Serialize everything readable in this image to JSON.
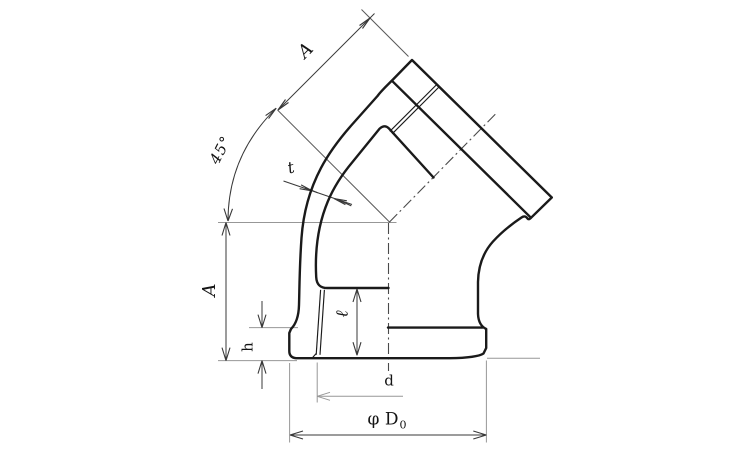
{
  "drawing": {
    "kind": "45-degree banded elbow, half-section dimension drawing",
    "labels": {
      "length_top": "A",
      "angle": "45°",
      "wall_thickness": "t",
      "length_left": "A",
      "band_height": "h",
      "thread_length": "ℓ",
      "inner_diameter": "d",
      "outer_diameter": "φ D",
      "outer_diameter_subscript": "0"
    },
    "colors": {
      "outline": "#1a1a1a",
      "dimension": "#383838",
      "extension": "#979797",
      "centerline": "#4a4a4a",
      "background": "#ffffff"
    }
  }
}
